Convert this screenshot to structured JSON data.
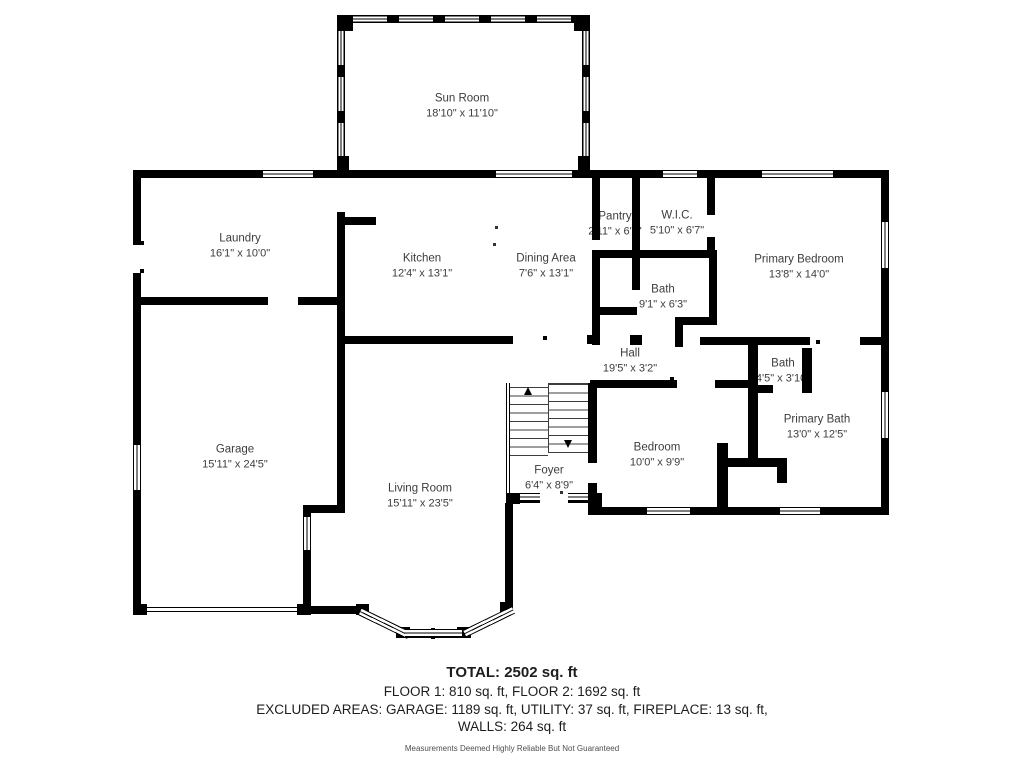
{
  "rooms": [
    {
      "id": "sun-room",
      "name": "Sun Room",
      "dims": "18'10\" x 11'10\""
    },
    {
      "id": "laundry",
      "name": "Laundry",
      "dims": "16'1\" x 10'0\""
    },
    {
      "id": "kitchen",
      "name": "Kitchen",
      "dims": "12'4\" x 13'1\""
    },
    {
      "id": "dining-area",
      "name": "Dining Area",
      "dims": "7'6\" x 13'1\""
    },
    {
      "id": "pantry",
      "name": "Pantry",
      "dims": "2'11\" x 6'7\""
    },
    {
      "id": "wic",
      "name": "W.I.C.",
      "dims": "5'10\" x 6'7\""
    },
    {
      "id": "primary-bedroom",
      "name": "Primary Bedroom",
      "dims": "13'8\" x 14'0\""
    },
    {
      "id": "bath",
      "name": "Bath",
      "dims": "9'1\" x 6'3\""
    },
    {
      "id": "hall",
      "name": "Hall",
      "dims": "19'5\" x 3'2\""
    },
    {
      "id": "bath-small",
      "name": "Bath",
      "dims": "4'5\" x 3'10\""
    },
    {
      "id": "primary-bath",
      "name": "Primary Bath",
      "dims": "13'0\" x 12'5\""
    },
    {
      "id": "bedroom",
      "name": "Bedroom",
      "dims": "10'0\" x 9'9\""
    },
    {
      "id": "foyer",
      "name": "Foyer",
      "dims": "6'4\" x 8'9\""
    },
    {
      "id": "garage",
      "name": "Garage",
      "dims": "15'11\" x 24'5\""
    },
    {
      "id": "living-room",
      "name": "Living Room",
      "dims": "15'11\" x 23'5\""
    }
  ],
  "summary": {
    "total": "TOTAL: 2502 sq. ft",
    "floors": "FLOOR 1: 810 sq. ft, FLOOR 2: 1692 sq. ft",
    "excluded": "EXCLUDED AREAS: GARAGE: 1189 sq. ft, UTILITY: 37 sq. ft, FIREPLACE: 13 sq. ft,",
    "walls": "WALLS: 264 sq. ft",
    "disclaimer": "Measurements Deemed Highly Reliable But Not Guaranteed"
  },
  "colors": {
    "wall": "#000000",
    "text": "#3d3d3d",
    "background": "#ffffff"
  }
}
